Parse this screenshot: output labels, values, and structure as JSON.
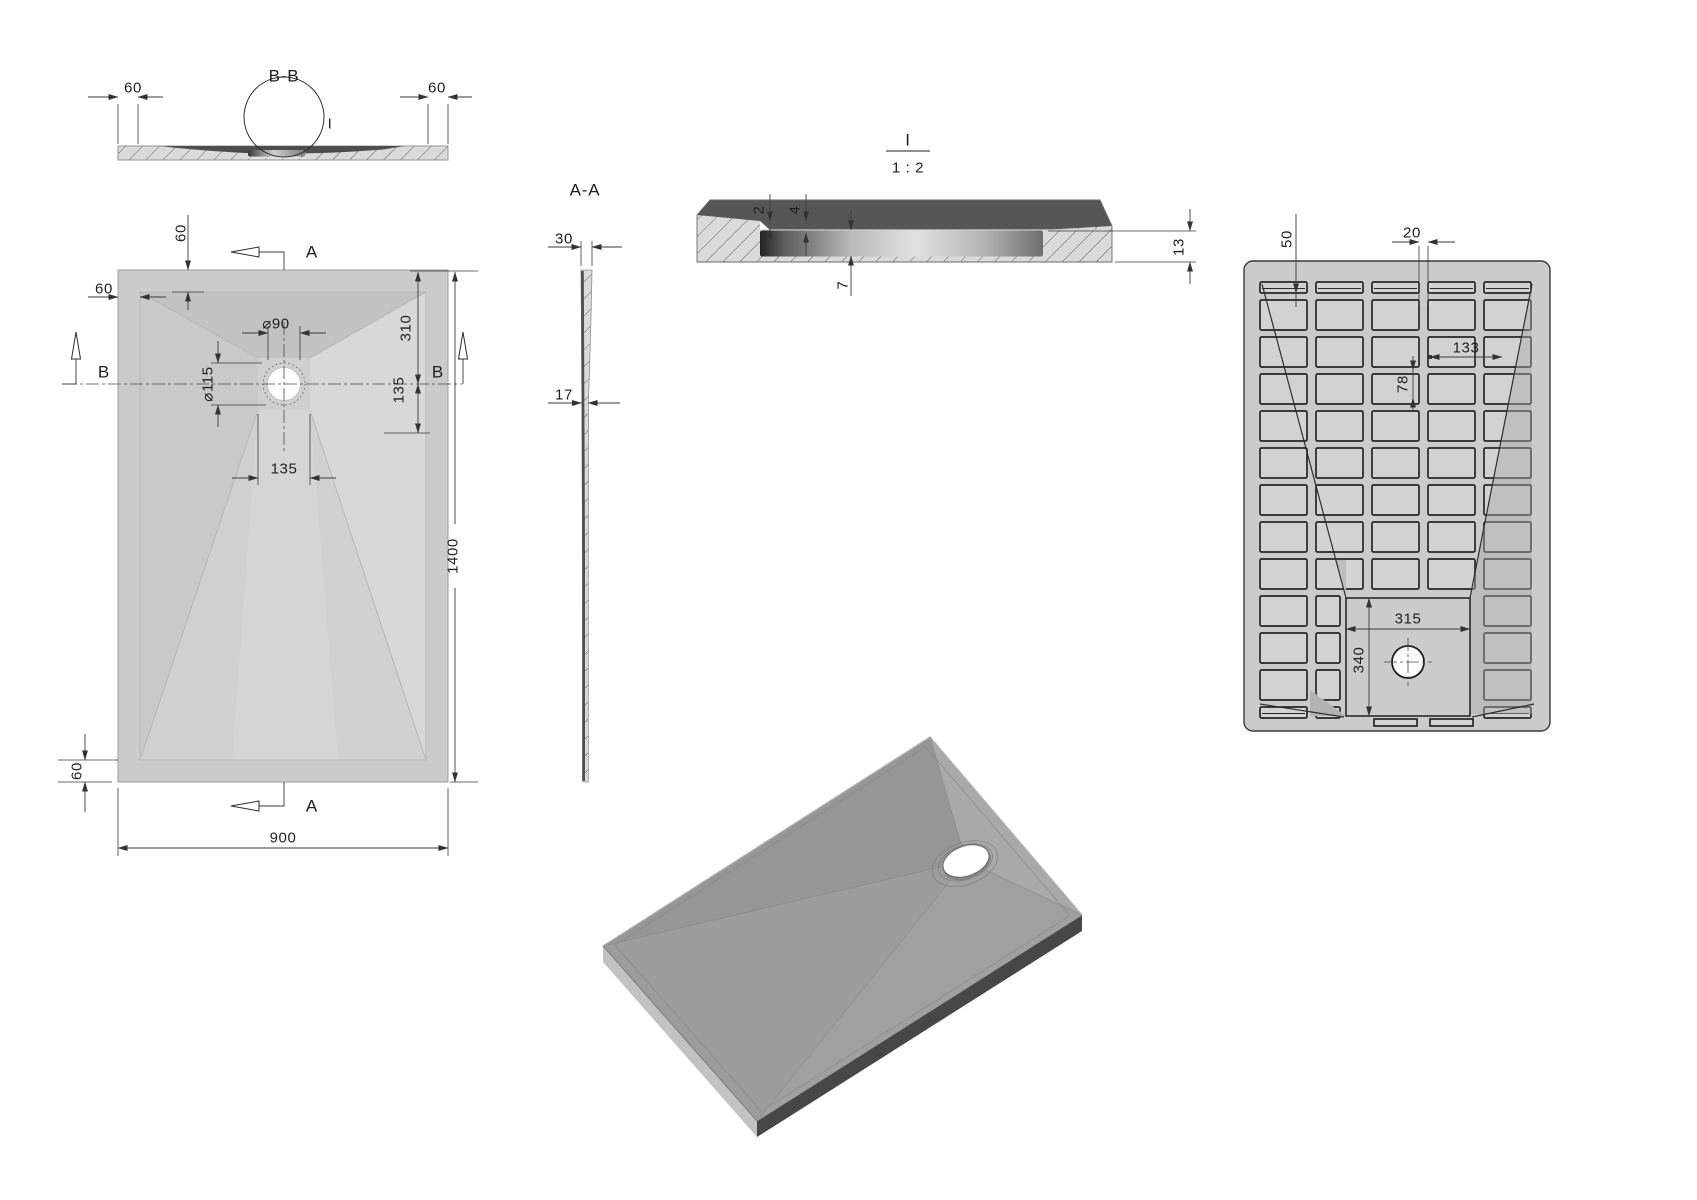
{
  "drawing": {
    "section_bb": {
      "title": "B-B",
      "detail_label": "I",
      "dim_left_border": "60",
      "dim_right_border": "60"
    },
    "plan_view": {
      "label_section_a_top": "A",
      "label_section_a_bottom": "A",
      "label_section_b_left": "B",
      "label_section_b_right": "B",
      "dim_top_border": "60",
      "dim_left_border": "60",
      "dim_bottom_border": "60",
      "dim_drain_diameter": "⌀90",
      "dim_recess_diameter": "⌀115",
      "dim_drain_from_top": "310",
      "dim_drain_offset": "135",
      "dim_channel_width": "135",
      "dim_length": "1400",
      "dim_width": "900"
    },
    "section_aa": {
      "title": "A-A",
      "dim_edge_thickness": "30",
      "dim_mid_thickness": "17"
    },
    "detail_i": {
      "title": "I",
      "scale": "1 : 2",
      "dim_lip": "2",
      "dim_step": "4",
      "dim_insert_depth": "7",
      "dim_total_thickness": "13"
    },
    "bottom_view": {
      "dim_pocket_size": "50",
      "dim_rib_width": "20",
      "dim_pocket_pitch_x": "133",
      "dim_pocket_pitch_y": "78",
      "dim_recess_width": "315",
      "dim_recess_height": "340"
    }
  }
}
